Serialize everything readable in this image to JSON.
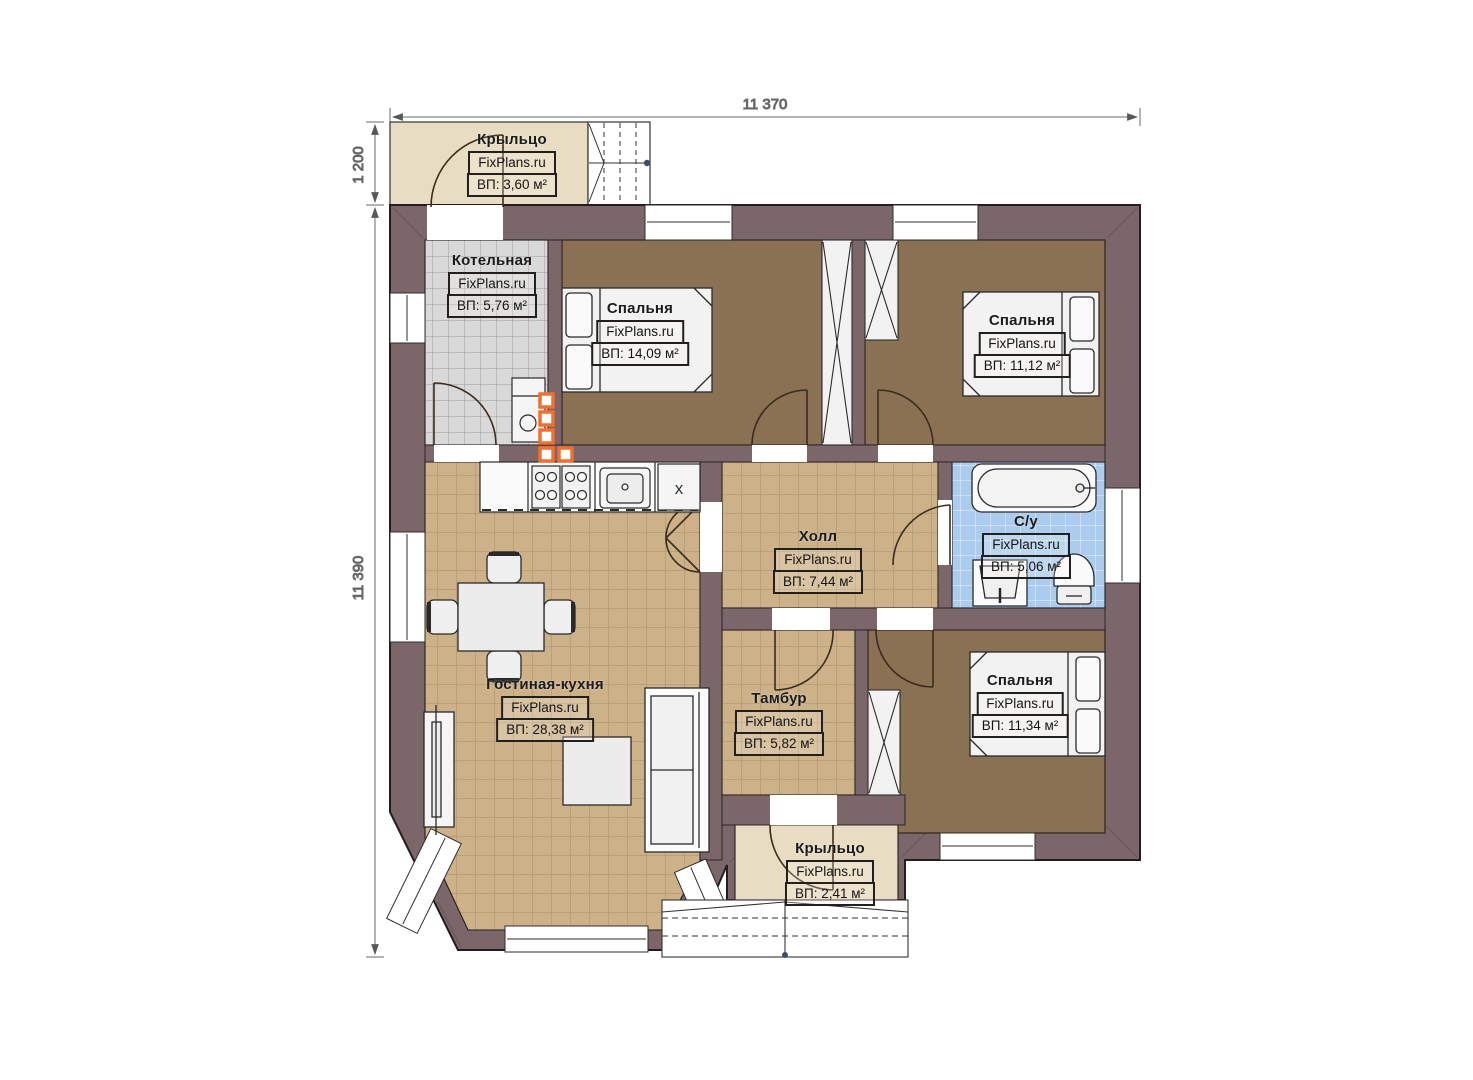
{
  "watermark": "FixPlans.ru",
  "dimensions": {
    "width_top": "11 370",
    "porch_height": "1 200",
    "height_left": "11 390"
  },
  "rooms": {
    "porch_top": {
      "name": "Крыльцо",
      "area": "ВП: 3,60 м²"
    },
    "boiler": {
      "name": "Котельная",
      "area": "ВП: 5,76 м²"
    },
    "bedroom1": {
      "name": "Спальня",
      "area": "ВП: 14,09 м²"
    },
    "bedroom2": {
      "name": "Спальня",
      "area": "ВП: 11,12 м²"
    },
    "hall": {
      "name": "Холл",
      "area": "ВП: 7,44 м²"
    },
    "bathroom": {
      "name": "С/у",
      "area": "ВП: 5,06 м²"
    },
    "living": {
      "name": "Гостиная-кухня",
      "area": "ВП: 28,38 м²"
    },
    "tambour": {
      "name": "Тамбур",
      "area": "ВП: 5,82 м²"
    },
    "bedroom3": {
      "name": "Спальня",
      "area": "ВП: 11,34 м²"
    },
    "porch_bottom": {
      "name": "Крыльцо",
      "area": "ВП: 2,41 м²"
    }
  },
  "kitchen": {
    "fridge_mark": "x"
  },
  "colors": {
    "wall": "#7b666a",
    "wall_line": "#241d20",
    "floor_beige": "#cdb289",
    "floor_brown": "#8a7153",
    "floor_gray": "#d9d9d9",
    "floor_blue": "#abccee",
    "porch": "#e8dcc2",
    "fixture": "#f7f7f7",
    "accent_orange": "#f07030",
    "dim": "#5f5f5f"
  }
}
